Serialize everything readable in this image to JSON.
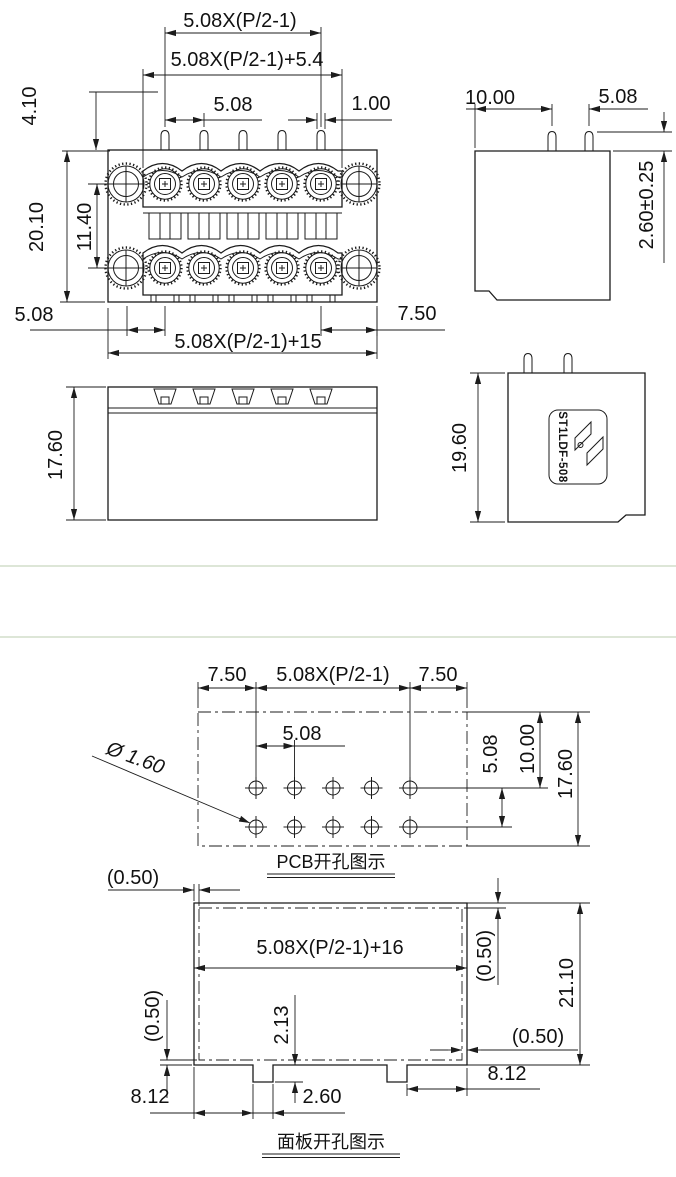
{
  "drawing": {
    "front_view": {
      "pin_span": "5.08X(P/2-1)",
      "span_plus_5_4": "5.08X(P/2-1)+5.4",
      "pin_pitch": "5.08",
      "pin_width": "1.00",
      "pin_offset_top": "4.10",
      "overall_height": "20.10",
      "row_spacing": "11.40",
      "left_offset": "5.08",
      "right_offset": "7.50",
      "overall_width": "5.08X(P/2-1)+15",
      "body_height": "17.60"
    },
    "side_view": {
      "flange_to_pin": "10.00",
      "pin_pitch": "5.08",
      "pin_protrusion": "2.60±0.25",
      "body_height": "19.60",
      "part_number": "ST1LDF-508"
    },
    "pcb_view": {
      "edge_left": "7.50",
      "pin_span": "5.08X(P/2-1)",
      "edge_right": "7.50",
      "pin_pitch": "5.08",
      "row_pitch": "5.08",
      "row_offset": "10.00",
      "overall_height": "17.60",
      "hole_diameter": "Ø 1.60",
      "caption": "PCB开孔图示"
    },
    "panel_view": {
      "clearance_top": "(0.50)",
      "clearance_left": "(0.50)",
      "clearance_right": "(0.50)",
      "clearance_bottom": "(0.50)",
      "cutout_width": "5.08X(P/2-1)+16",
      "cutout_height": "21.10",
      "notch_offset_left": "8.12",
      "notch_offset_right": "8.12",
      "notch_width": "2.60",
      "notch_depth": "2.13",
      "caption": "面板开孔图示"
    }
  }
}
